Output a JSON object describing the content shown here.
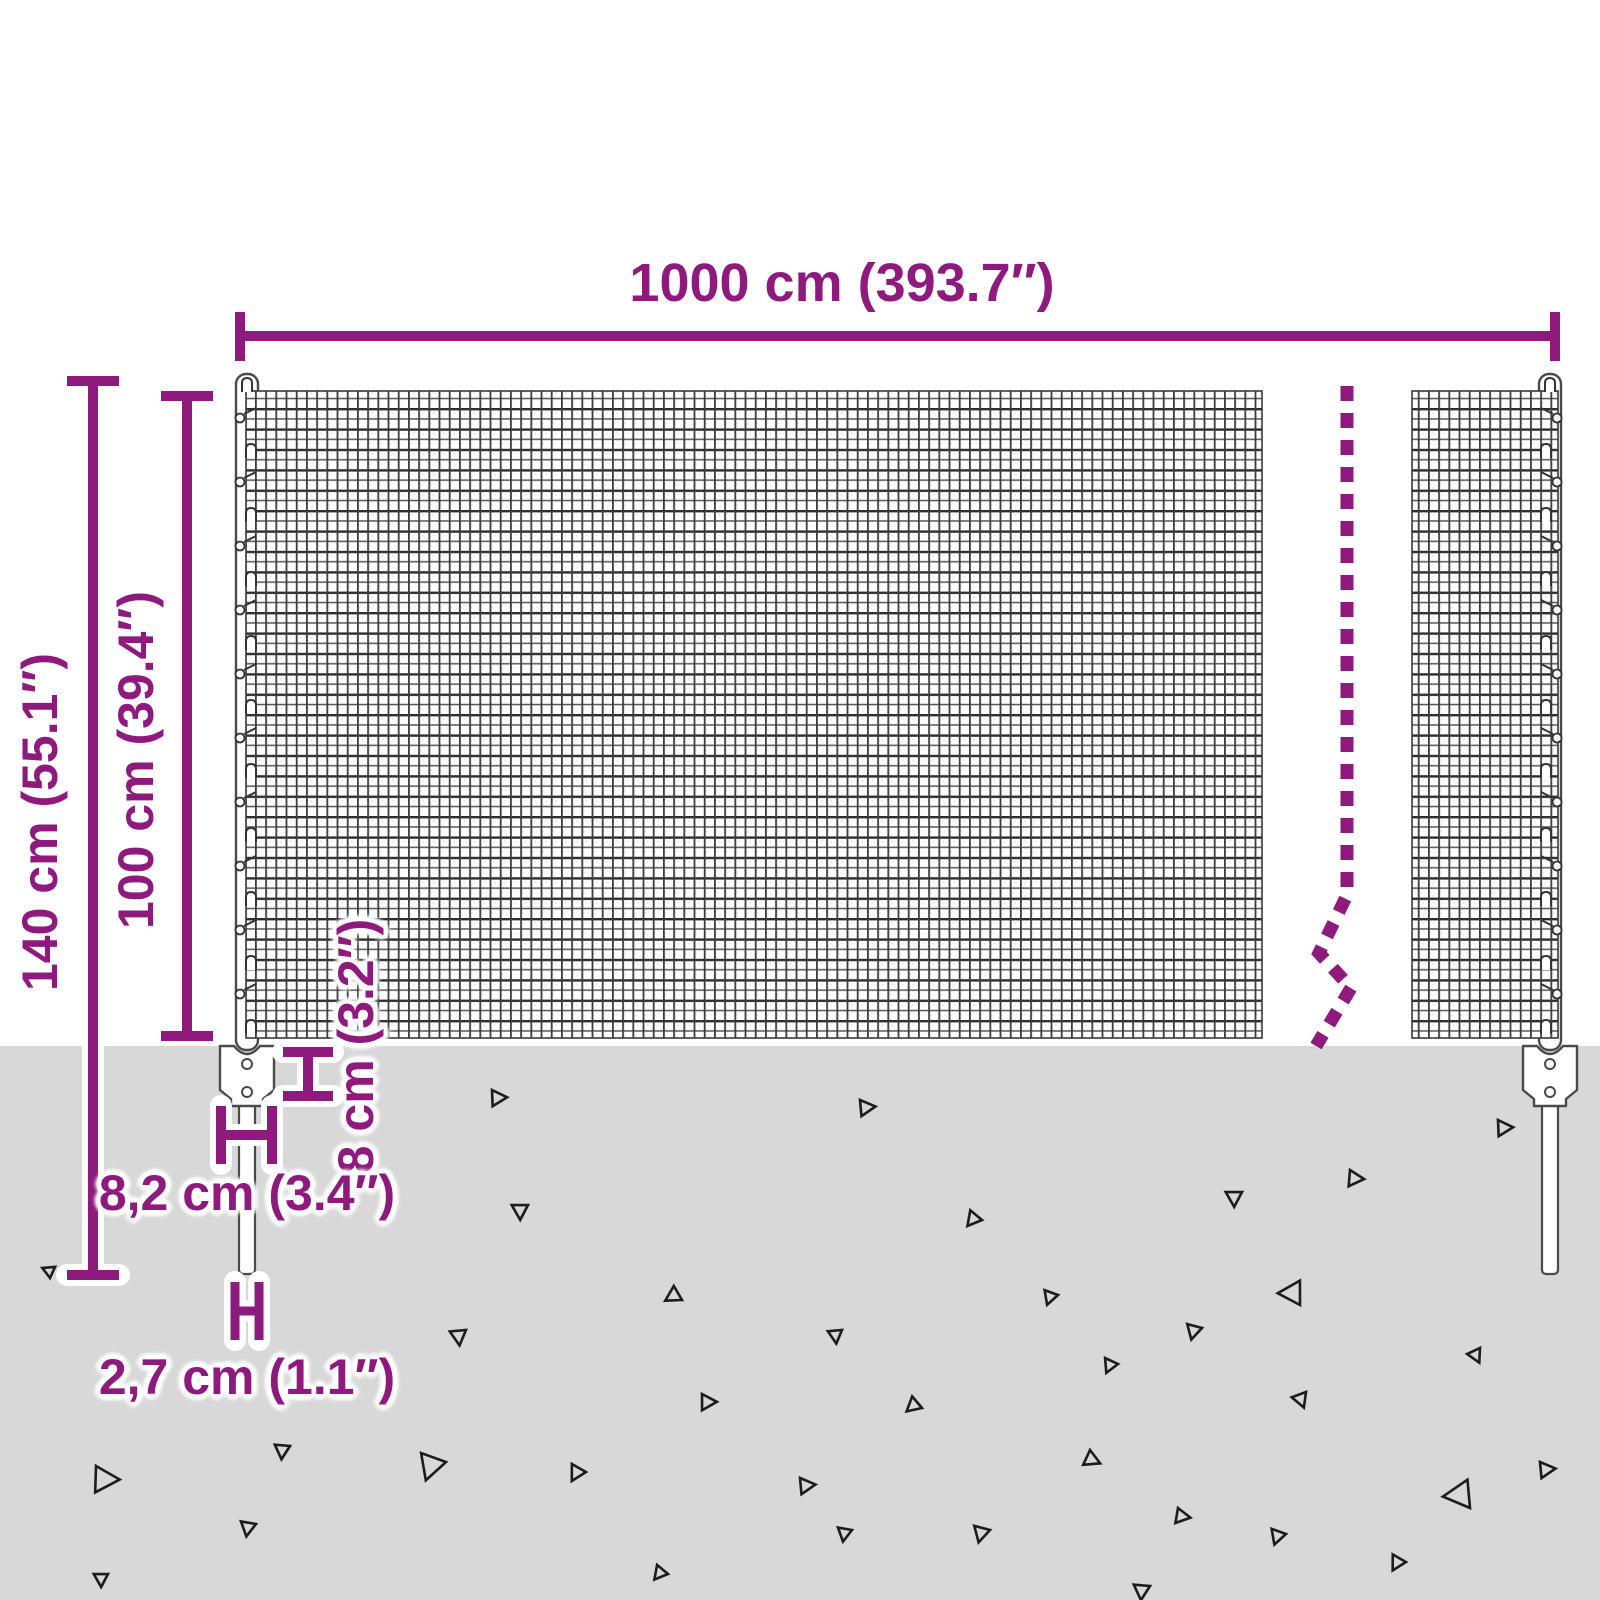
{
  "diagram": {
    "title": "wire mesh fence with posts - dimension diagram",
    "labels": {
      "total_width": "1000 cm (393.7″)",
      "total_height": "140 cm (55.1″)",
      "fence_height": "100 cm (39.4″)",
      "anchor_depth": "8 cm (3.2″)",
      "plate_width": "8,2 cm (3.4″)",
      "spike_width": "2,7 cm (1.1″)"
    },
    "colors": {
      "dimension_purple": "#8e1a7e",
      "ground_gray": "#d8d8d8",
      "mesh_line": "#3a3a3a",
      "outline_gray": "#4a4a4a",
      "gravel_dark": "#1c1c1c",
      "background": "#ffffff"
    },
    "dash_line": {
      "points": "1347,386 1347,895 1319,953 1351,988 1316,1046",
      "dash": "15 12",
      "width": 13
    },
    "posts": {
      "left_cx": 247,
      "right_cx": 1550,
      "clip_rows": 10,
      "clip_spacing": 64,
      "clip_start_y": 418
    },
    "gravel_triangles": [
      {
        "x": 492,
        "y": 1090,
        "s": 16,
        "r": 8
      },
      {
        "x": 528,
        "y": 1205,
        "s": 16,
        "r": 100
      },
      {
        "x": 352,
        "y": 1196,
        "s": 12,
        "r": 150
      },
      {
        "x": 50,
        "y": 1278,
        "s": 12,
        "r": 215
      },
      {
        "x": 466,
        "y": 1330,
        "s": 16,
        "r": 95
      },
      {
        "x": 682,
        "y": 1300,
        "s": 16,
        "r": 160
      },
      {
        "x": 702,
        "y": 1394,
        "s": 16,
        "r": 10
      },
      {
        "x": 96,
        "y": 1466,
        "s": 26,
        "r": 12
      },
      {
        "x": 290,
        "y": 1446,
        "s": 15,
        "r": 105
      },
      {
        "x": 446,
        "y": 1462,
        "s": 26,
        "r": 120
      },
      {
        "x": 586,
        "y": 1472,
        "s": 16,
        "r": 130
      },
      {
        "x": 256,
        "y": 1524,
        "s": 15,
        "r": 110
      },
      {
        "x": 108,
        "y": 1574,
        "s": 14,
        "r": 100
      },
      {
        "x": 668,
        "y": 1574,
        "s": 14,
        "r": 140
      },
      {
        "x": 860,
        "y": 1100,
        "s": 16,
        "r": 5
      },
      {
        "x": 1498,
        "y": 1120,
        "s": 16,
        "r": 8
      },
      {
        "x": 1350,
        "y": 1170,
        "s": 16,
        "r": 15
      },
      {
        "x": 1242,
        "y": 1192,
        "s": 16,
        "r": 100
      },
      {
        "x": 982,
        "y": 1220,
        "s": 15,
        "r": 140
      },
      {
        "x": 1058,
        "y": 1295,
        "s": 14,
        "r": 120
      },
      {
        "x": 1300,
        "y": 1305,
        "s": 24,
        "r": 190
      },
      {
        "x": 1202,
        "y": 1328,
        "s": 15,
        "r": 115
      },
      {
        "x": 842,
        "y": 1330,
        "s": 14,
        "r": 95
      },
      {
        "x": 1118,
        "y": 1364,
        "s": 14,
        "r": 125
      },
      {
        "x": 1480,
        "y": 1348,
        "s": 14,
        "r": 75
      },
      {
        "x": 1306,
        "y": 1392,
        "s": 15,
        "r": 80
      },
      {
        "x": 922,
        "y": 1408,
        "s": 15,
        "r": 150
      },
      {
        "x": 1090,
        "y": 1450,
        "s": 16,
        "r": 35
      },
      {
        "x": 800,
        "y": 1478,
        "s": 16,
        "r": 5
      },
      {
        "x": 1178,
        "y": 1508,
        "s": 15,
        "r": 20
      },
      {
        "x": 1540,
        "y": 1462,
        "s": 16,
        "r": 5
      },
      {
        "x": 1470,
        "y": 1508,
        "s": 28,
        "r": 185
      },
      {
        "x": 990,
        "y": 1530,
        "s": 16,
        "r": 115
      },
      {
        "x": 852,
        "y": 1530,
        "s": 14,
        "r": 110
      },
      {
        "x": 1286,
        "y": 1534,
        "s": 15,
        "r": 120
      },
      {
        "x": 1406,
        "y": 1562,
        "s": 15,
        "r": 130
      },
      {
        "x": 1150,
        "y": 1586,
        "s": 16,
        "r": 105
      }
    ]
  }
}
